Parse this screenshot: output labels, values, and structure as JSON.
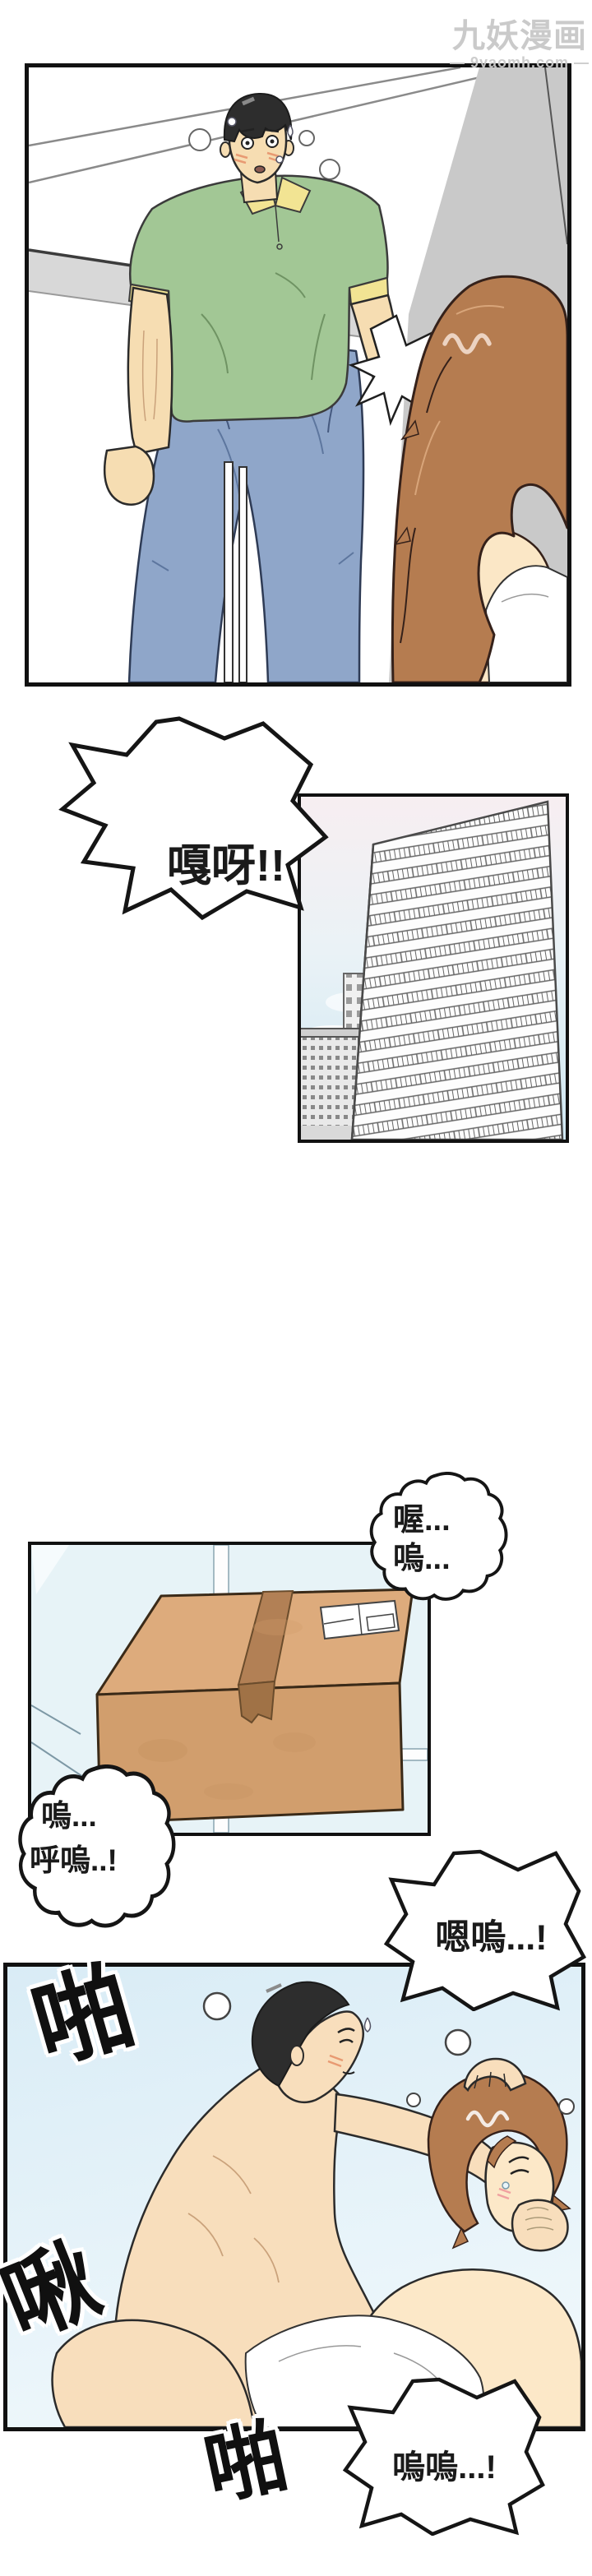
{
  "watermark": {
    "brand": "九妖漫画",
    "site_line": "— 9yaomh.com —"
  },
  "bubbles": {
    "shout": {
      "text": "嘎呀!!"
    },
    "moan1": {
      "line1": "喔...",
      "line2": "嗚..."
    },
    "moan2": {
      "line1": "嗚...",
      "line2": "呼嗚..!"
    },
    "moan3": {
      "text": "嗯嗚...!"
    },
    "moan4": {
      "text": "嗚嗚...!"
    }
  },
  "sfx": {
    "slap_top": "啪",
    "kiss": "啾",
    "slap_bottom": "啪"
  },
  "colors": {
    "panel_border": "#111111",
    "shirt_green": "#a2c795",
    "collar_yellow": "#f2e493",
    "jeans_blue": "#8fa6c9",
    "man_skin": "#f6ddb2",
    "woman_skin": "#fce8c8",
    "woman_hair_brown": "#b57c50",
    "man_hair": "#2d2d2d",
    "wall_gray": "#c9c9c9",
    "box_brown": "#d19e6d",
    "sky_blue": "#cfe8f3",
    "room_bg_blue": "#e7f3f7",
    "watermark_gray": "#c6c6c6"
  }
}
